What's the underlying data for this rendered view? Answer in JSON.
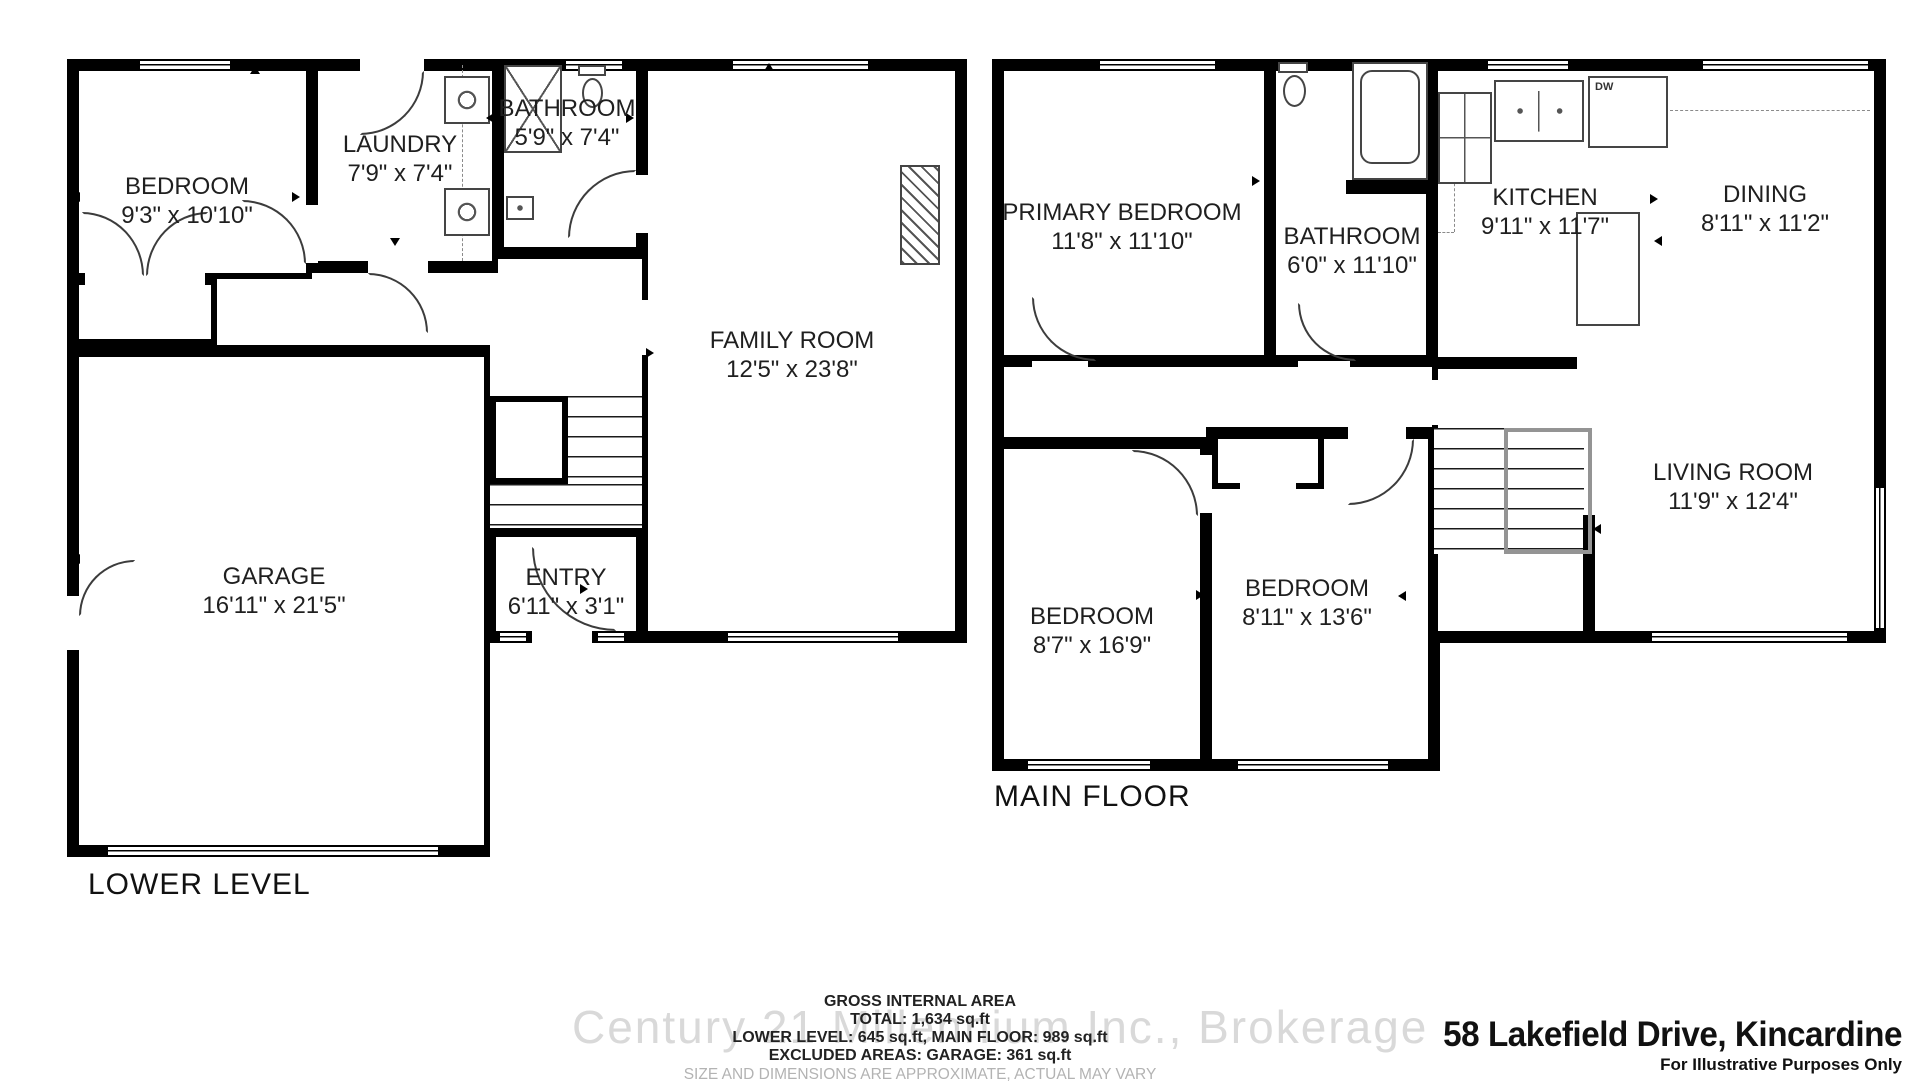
{
  "lower_level": {
    "label": "LOWER LEVEL",
    "rooms": [
      {
        "name": "BEDROOM",
        "dims": "9'3\" x 10'10\""
      },
      {
        "name": "LAUNDRY",
        "dims": "7'9\" x 7'4\""
      },
      {
        "name": "BATHROOM",
        "dims": "5'9\" x 7'4\""
      },
      {
        "name": "FAMILY ROOM",
        "dims": "12'5\" x 23'8\""
      },
      {
        "name": "GARAGE",
        "dims": "16'11\" x 21'5\""
      },
      {
        "name": "ENTRY",
        "dims": "6'11\" x 3'1\""
      }
    ]
  },
  "main_floor": {
    "label": "MAIN FLOOR",
    "dishwasher_label": "DW",
    "rooms": [
      {
        "name": "PRIMARY BEDROOM",
        "dims": "11'8\" x 11'10\""
      },
      {
        "name": "BATHROOM",
        "dims": "6'0\" x 11'10\""
      },
      {
        "name": "KITCHEN",
        "dims": "9'11\" x 11'7\""
      },
      {
        "name": "DINING",
        "dims": "8'11\" x 11'2\""
      },
      {
        "name": "LIVING ROOM",
        "dims": "11'9\" x 12'4\""
      },
      {
        "name": "BEDROOM",
        "dims": "8'7\" x 16'9\""
      },
      {
        "name": "BEDROOM",
        "dims": "8'11\" x 13'6\""
      }
    ]
  },
  "area_summary": {
    "title": "GROSS INTERNAL AREA",
    "total": "TOTAL: 1,634 sq.ft",
    "levels": "LOWER LEVEL: 645 sq.ft, MAIN FLOOR: 989 sq.ft",
    "excluded": "EXCLUDED AREAS: GARAGE: 361 sq.ft",
    "disclaimer": "SIZE AND DIMENSIONS ARE APPROXIMATE, ACTUAL MAY VARY"
  },
  "watermark": "Century 21 Millennium Inc., Brokerage",
  "footer": {
    "address": "58 Lakefield Drive, Kincardine",
    "note": "For Illustrative Purposes Only"
  }
}
